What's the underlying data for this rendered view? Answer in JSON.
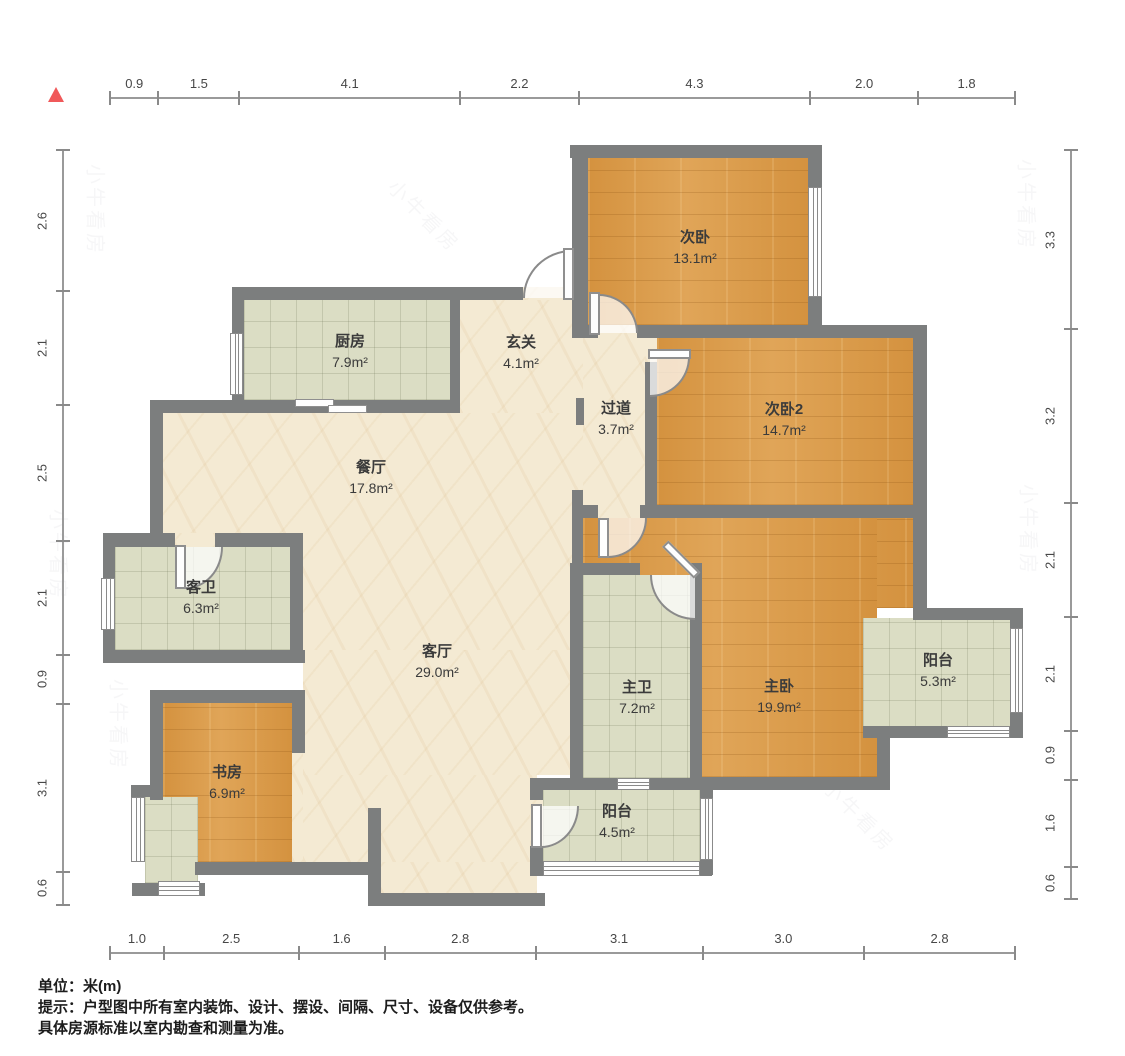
{
  "title": "户型图",
  "footer": {
    "unit_note": "单位：米(m)",
    "tip_line1": "提示：户型图中所有室内装饰、设计、摆设、间隔、尺寸、设备仅供参考。",
    "tip_line2": "具体房源标准以室内勘查和测量为准。"
  },
  "watermark_text": "小牛看房",
  "colors": {
    "north_marker": "#f0595a",
    "wall": "#7c7e7e",
    "wood_floor": "#d89a4a",
    "tile_floor": "#dbddc4",
    "stone_floor": "#f4ead3"
  },
  "rulers": {
    "top": [
      "0.9",
      "1.5",
      "4.1",
      "2.2",
      "4.3",
      "2.0",
      "1.8"
    ],
    "bottom": [
      "1.0",
      "2.5",
      "1.6",
      "2.8",
      "3.1",
      "3.0",
      "2.8"
    ],
    "left": [
      "2.6",
      "2.1",
      "2.5",
      "2.1",
      "0.9",
      "3.1",
      "0.6"
    ],
    "right": [
      "3.3",
      "3.2",
      "2.1",
      "2.1",
      "0.9",
      "1.6",
      "0.6"
    ]
  },
  "rooms": [
    {
      "id": "ciwo",
      "name": "次卧",
      "area": "13.1m²"
    },
    {
      "id": "ciwo2",
      "name": "次卧2",
      "area": "14.7m²"
    },
    {
      "id": "zhuwo",
      "name": "主卧",
      "area": "19.9m²"
    },
    {
      "id": "chufang",
      "name": "厨房",
      "area": "7.9m²"
    },
    {
      "id": "xuanguan",
      "name": "玄关",
      "area": "4.1m²"
    },
    {
      "id": "guodao",
      "name": "过道",
      "area": "3.7m²"
    },
    {
      "id": "canting",
      "name": "餐厅",
      "area": "17.8m²"
    },
    {
      "id": "kewei",
      "name": "客卫",
      "area": "6.3m²"
    },
    {
      "id": "keting",
      "name": "客厅",
      "area": "29.0m²"
    },
    {
      "id": "zhuwei",
      "name": "主卫",
      "area": "7.2m²"
    },
    {
      "id": "yangtai53",
      "name": "阳台",
      "area": "5.3m²"
    },
    {
      "id": "shufang",
      "name": "书房",
      "area": "6.9m²"
    },
    {
      "id": "yangtai45",
      "name": "阳台",
      "area": "4.5m²"
    }
  ]
}
